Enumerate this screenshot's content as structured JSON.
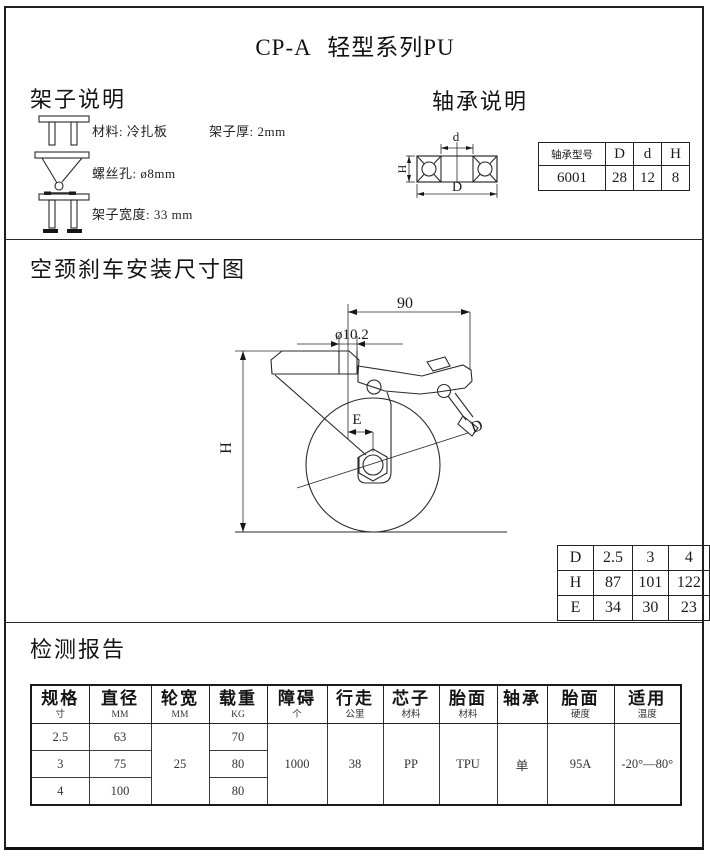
{
  "title": "CP-A 轻型系列PU",
  "frame": {
    "heading": "架子说明",
    "row1_label": "材料: 冷扎板",
    "row1_label2": "架子厚: 2mm",
    "row2_label": "螺丝孔: ø8mm",
    "row3_label": "架子宽度: 33 mm"
  },
  "bearing": {
    "heading": "轴承说明",
    "drawing": {
      "d": "d",
      "D": "D",
      "H": "H"
    },
    "table": {
      "model_header": "轴承型号",
      "col_D": "D",
      "col_d": "d",
      "col_H": "H",
      "model": "6001",
      "val_D": "28",
      "val_d": "12",
      "val_H": "8"
    }
  },
  "drawing": {
    "heading": "空颈刹车安装尺寸图",
    "dim_width": "90",
    "dim_hole": "ø10.2",
    "dim_H": "H",
    "dim_E": "E",
    "dim_D": "D",
    "dhe": [
      [
        "D",
        "2.5",
        "3",
        "4"
      ],
      [
        "H",
        "87",
        "101",
        "122"
      ],
      [
        "E",
        "34",
        "30",
        "23"
      ]
    ]
  },
  "report": {
    "heading": "检测报告",
    "headers": [
      {
        "main": "规格",
        "sub": "寸"
      },
      {
        "main": "直径",
        "sub": "MM"
      },
      {
        "main": "轮宽",
        "sub": "MM"
      },
      {
        "main": "载重",
        "sub": "KG"
      },
      {
        "main": "障碍",
        "sub": "个"
      },
      {
        "main": "行走",
        "sub": "公里"
      },
      {
        "main": "芯子",
        "sub": "材料"
      },
      {
        "main": "胎面",
        "sub": "材料"
      },
      {
        "main": "轴承",
        "sub": ""
      },
      {
        "main": "胎面",
        "sub": "硬度"
      },
      {
        "main": "适用",
        "sub": "温度"
      }
    ],
    "rows": {
      "spec": [
        "2.5",
        "3",
        "4"
      ],
      "diameter": [
        "63",
        "75",
        "100"
      ],
      "wheel_width": "25",
      "load": [
        "70",
        "80",
        "80"
      ],
      "obstacle": "1000",
      "distance": "38",
      "core_material": "PP",
      "tread_material": "TPU",
      "bearing": "单",
      "tread_hardness": "95A",
      "temperature": "-20°—80°"
    }
  }
}
